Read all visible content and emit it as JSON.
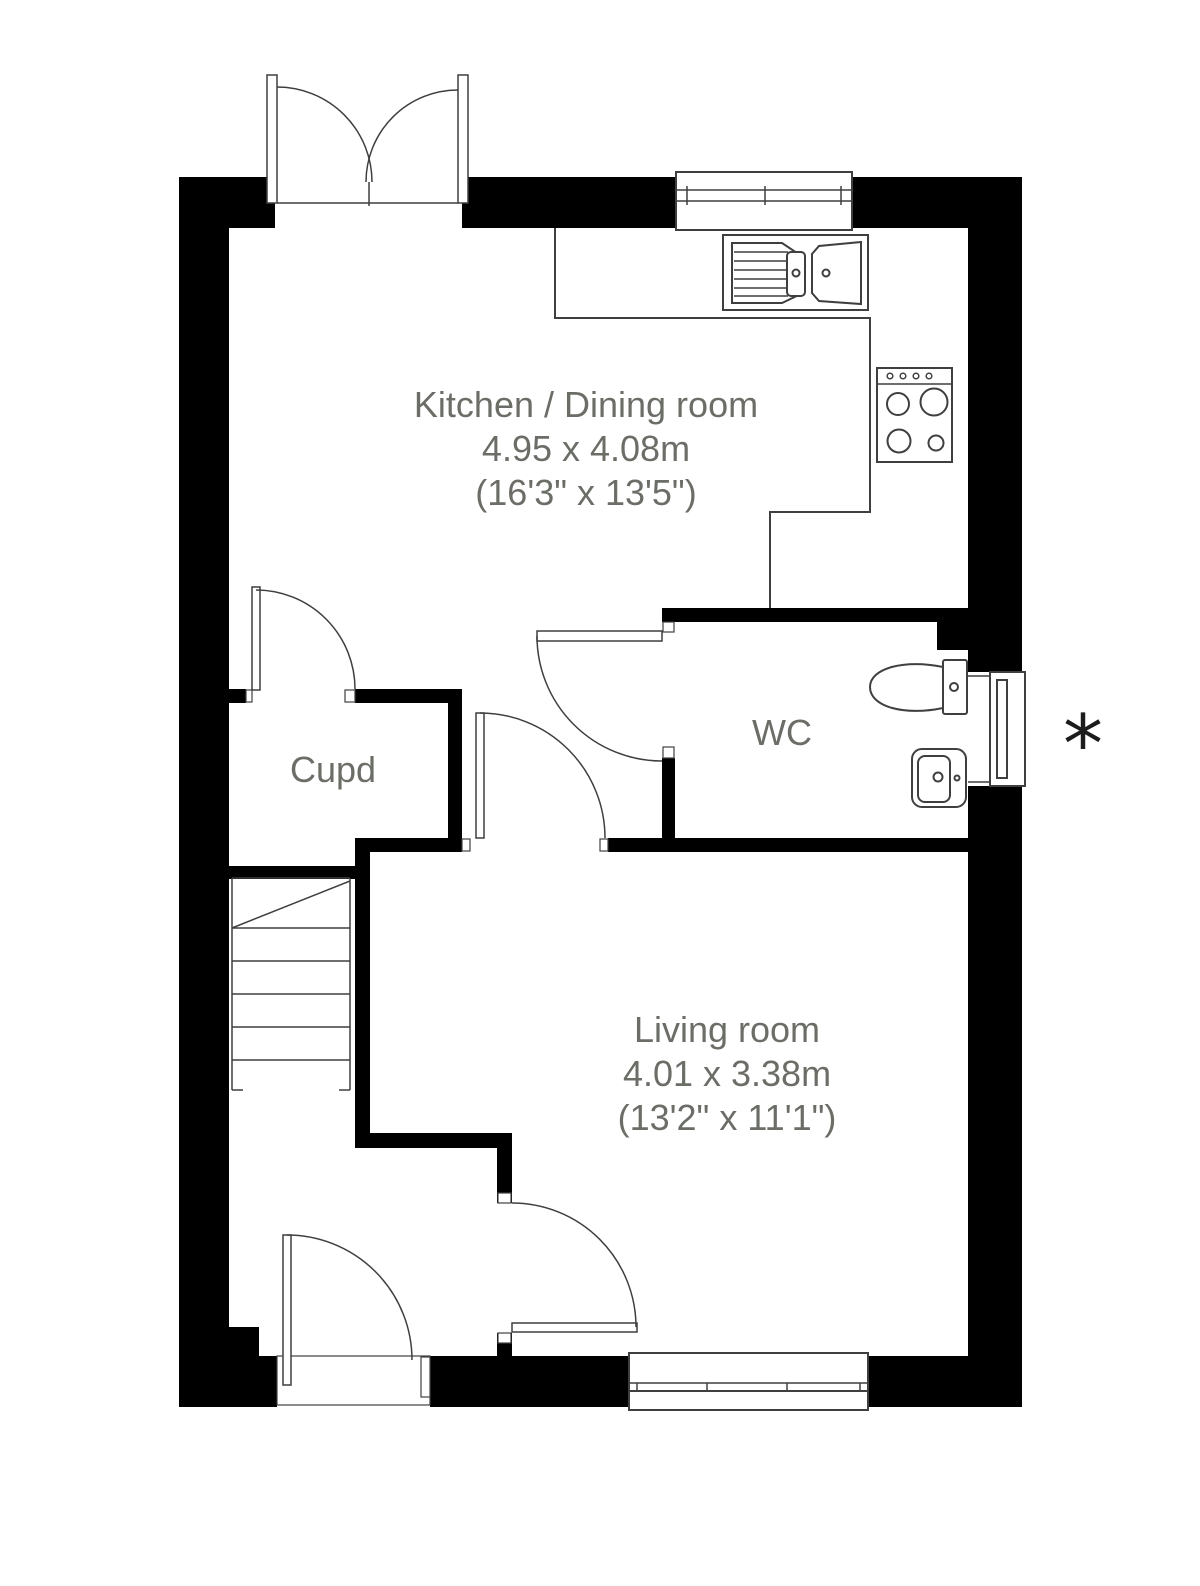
{
  "colors": {
    "wall": "#000000",
    "line": "#3f3f3f",
    "label": "#6b6e67",
    "asterisk": "#1c1c1c",
    "bg": "#ffffff"
  },
  "rooms": [
    {
      "name": "Kitchen / Dining room",
      "dim_m": "4.95 x 4.08m",
      "dim_ft": "(16'3\" x 13'5\")"
    },
    {
      "name": "Cupd"
    },
    {
      "name": "WC"
    },
    {
      "name": "Living room",
      "dim_m": "4.01 x 3.38m",
      "dim_ft": "(13'2\" x 11'1\")"
    }
  ],
  "annotations": {
    "asterisk": "*"
  },
  "fixtures": [
    "french-doors",
    "kitchen-window",
    "sink-drainer-unit",
    "hob-4-burner",
    "kitchen-counter",
    "cupboard-door",
    "wc-door",
    "toilet",
    "basin",
    "wc-window",
    "staircase",
    "hall-living-door",
    "front-door",
    "living-room-window"
  ]
}
